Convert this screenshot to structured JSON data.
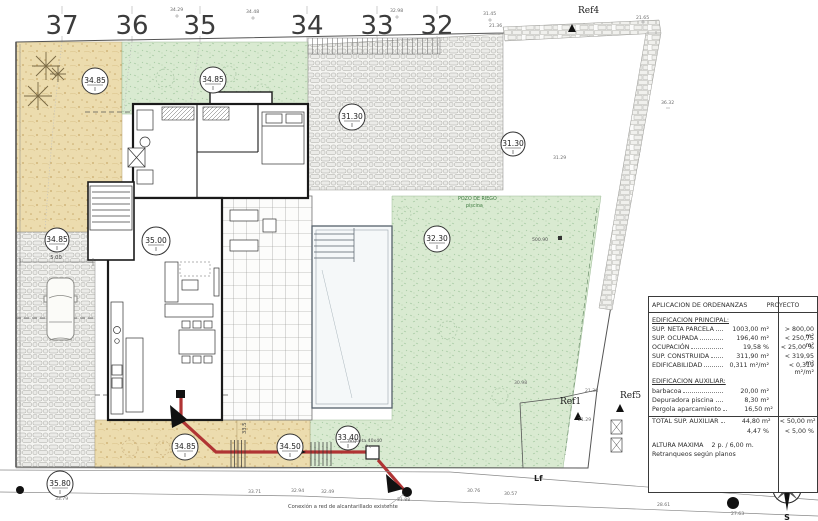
{
  "colors": {
    "sand": "#ecdcae",
    "grass": "#d9ead1",
    "cobble": "#f2f2ef",
    "accent_red": "#b03434",
    "wall": "#1a1a1a"
  },
  "contour_labels": [
    "37",
    "36",
    "35",
    "34",
    "33",
    "32"
  ],
  "markers": [
    {
      "value": "34.85"
    },
    {
      "value": "34.85"
    },
    {
      "value": "31.30"
    },
    {
      "value": "31.30"
    },
    {
      "value": "35.00"
    },
    {
      "value": "32.30"
    },
    {
      "value": "34.85"
    },
    {
      "value": "34.85"
    },
    {
      "value": "34.50"
    },
    {
      "value": "33.40"
    },
    {
      "value": "35.80"
    }
  ],
  "refs": {
    "ref4": "Ref4",
    "ref1": "Ref1",
    "ref5": "Ref5",
    "lf": "Lf"
  },
  "annotations": {
    "pozo_line1": "POZO DE RIEGO",
    "pozo_line2": "piscina",
    "arqueta": "Arqueta 40x40",
    "sewer_note": "Conexión a red de alcantarillado existente",
    "dim_drive": "5.00",
    "dim_side": "33.5",
    "level_500": "500.90"
  },
  "spot_levels": [
    "34.29",
    "34.48",
    "32.98",
    "31.45",
    "21.36",
    "21.65",
    "36.32",
    "31.29",
    "21.38",
    "21.29",
    "33.71",
    "32.94",
    "32.49",
    "31.88",
    "30.76",
    "30.57",
    "23.37",
    "28.61",
    "27.63",
    "33.79",
    "30.98"
  ],
  "table": {
    "header": {
      "col1": "APLICACION DE ORDENANZAS",
      "col2": "PROYECTO",
      "col3": "PGOU"
    },
    "section1": "EDIFICACION PRINCIPAL:",
    "rows1": [
      {
        "label": "SUP. NETA PARCELA",
        "val": "1003,00 m²",
        "norm": "> 800,00 m²"
      },
      {
        "label": "SUP. OCUPADA",
        "val": "196,40 m²",
        "norm": "< 250,75 m²"
      },
      {
        "label": "OCUPACIÓN",
        "val": "19,58 %",
        "norm": "< 25,00 %"
      },
      {
        "label": "SUP. CONSTRUIDA",
        "val": "311,90 m²",
        "norm": "< 319,95 m²"
      },
      {
        "label": "EDIFICABILIDAD",
        "val": "0,311 m²/m²",
        "norm": "< 0,319 m²/m²"
      }
    ],
    "section2": "EDIFICACION AUXILIAR:",
    "rows2": [
      {
        "label": "barbacoa",
        "val": "20,00 m²",
        "norm": ""
      },
      {
        "label": "Depuradora piscina",
        "val": "8,30 m²",
        "norm": ""
      },
      {
        "label": "Pergola aparcamiento",
        "val": "16,50 m²",
        "norm": ""
      }
    ],
    "total_row": {
      "label": "TOTAL SUP. AUXILIAR",
      "val": "44,80 m²",
      "norm": "< 50,00 m²"
    },
    "total_pct": {
      "val": "4,47 %",
      "norm": "< 5,00 %"
    },
    "altura": {
      "label": "ALTURA MAXIMA",
      "val": "2 p. / 6,00 m."
    },
    "retranqueos": "Retranqueos según planos"
  },
  "compass": {
    "n": "N",
    "s": "S",
    "e": "E",
    "o": "O"
  }
}
